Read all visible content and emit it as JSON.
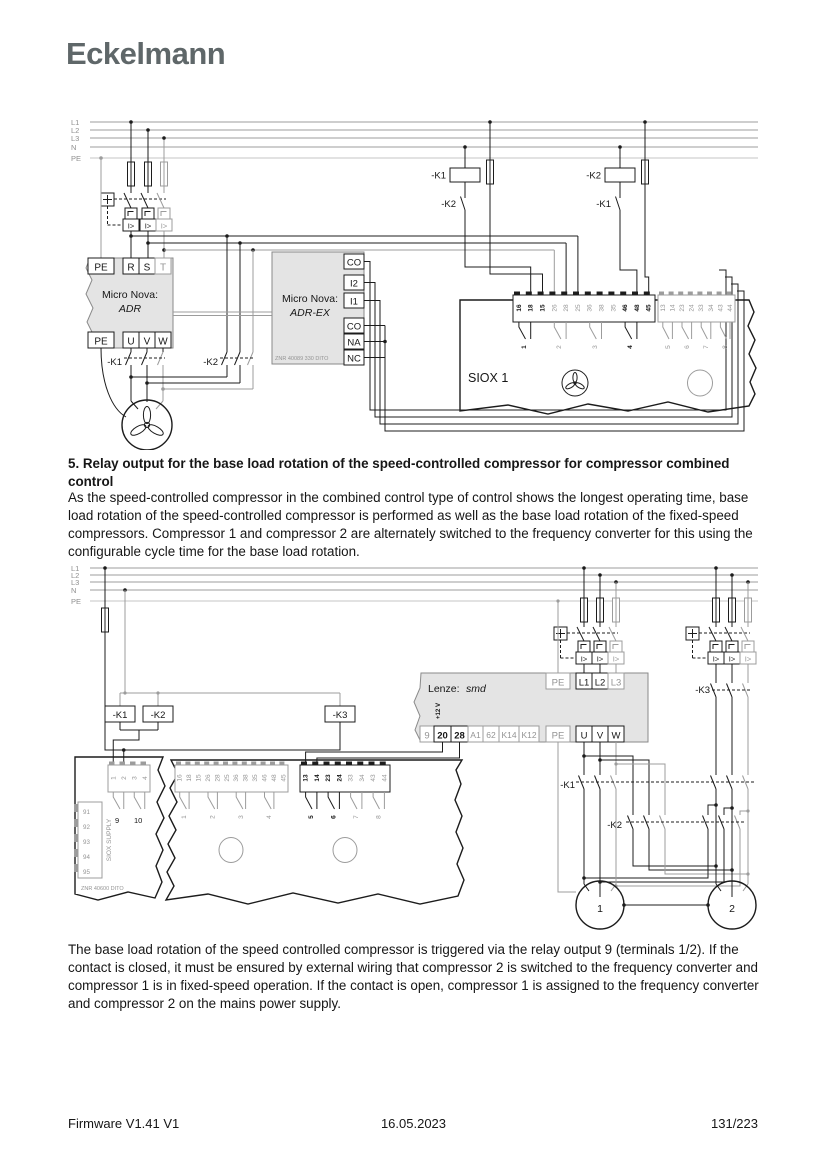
{
  "logo": "Eckelmann",
  "section": {
    "heading": "5. Relay output for the base load rotation of the speed-controlled compressor for compressor combined control",
    "para1": "As the speed-controlled compressor in the combined control type of control shows the longest operating time, base load rotation of the speed-controlled compressor is performed as well as the base load rotation of the fixed-speed compressors. Compressor 1 and compressor 2 are alternately switched to the frequency converter for this using the configurable cycle time for the base load rotation.",
    "para2": "The base load rotation of the speed controlled compressor is triggered via the relay output 9 (terminals 1/2). If the contact is closed, it must be ensured by external wiring that compressor 2 is switched to the frequency converter and compressor 1 is in fixed-speed operation. If the contact is open, compressor 1 is assigned to the frequency converter and compressor 2 on the mains power supply.",
    "overload_symbol": "I>"
  },
  "footer": {
    "left": "Firmware V1.41 V1",
    "center": "16.05.2023",
    "right": "131/223"
  },
  "colors": {
    "logo": "#5f6769",
    "line": "#1c1c1c",
    "gray_line": "#9c9c9c",
    "box_fill": "#e4e4e4"
  },
  "d1": {
    "rails": [
      "L1",
      "L2",
      "L3",
      "N",
      "PE"
    ],
    "adr_title": "Micro Nova:",
    "adr_model": "ADR",
    "adr_top": [
      "PE",
      "R",
      "S",
      "T"
    ],
    "adr_bottom": [
      "PE",
      "U",
      "V",
      "W"
    ],
    "k1": "-K1",
    "k2": "-K2",
    "adrex_title": "Micro Nova:",
    "adrex_model": "ADR-EX",
    "adrex_part": "ZNR 40089 330 DITO",
    "adrex_terms": [
      "CO",
      "I2",
      "I1",
      "CO",
      "NA",
      "NC"
    ],
    "coil1": "-K1",
    "coil1_aux": "-K2",
    "coil2": "-K2",
    "coil2_aux": "-K1",
    "siox_label": "SIOX 1",
    "strip1": [
      "16",
      "18",
      "15",
      "26",
      "28",
      "25",
      "36",
      "38",
      "35",
      "46",
      "48",
      "45"
    ],
    "relays1": [
      "1",
      "2",
      "3",
      "4"
    ],
    "strip2": [
      "13",
      "14",
      "23",
      "24",
      "33",
      "34",
      "43",
      "44"
    ],
    "relays2": [
      "5",
      "6",
      "7",
      "8"
    ]
  },
  "d2": {
    "rails": [
      "L1",
      "L2",
      "L3",
      "N",
      "PE"
    ],
    "k1": "-K1",
    "k2": "-K2",
    "k3": "-K3",
    "k1_row": "-K1",
    "k2_row": "-K2",
    "k3_row": "-K3",
    "lenze_brand": "Lenze:",
    "lenze_model": "smd",
    "v12": "+12 V",
    "lenze_top": [
      "PE",
      "L1",
      "L2",
      "L3"
    ],
    "lenze_bottom": [
      "9",
      "20",
      "28",
      "A1",
      "62",
      "K14",
      "K12",
      "PE",
      "U",
      "V",
      "W"
    ],
    "m1_strip": [
      "1",
      "2",
      "3",
      "4"
    ],
    "m1_relays": [
      "9",
      "10"
    ],
    "m1_side": [
      "91",
      "92",
      "93",
      "94",
      "95"
    ],
    "m1_supply": "SIOX SUPPLY",
    "m1_part": "ZNR 40600 DITO",
    "strip1": [
      "16",
      "18",
      "15",
      "26",
      "28",
      "25",
      "36",
      "38",
      "35",
      "46",
      "48",
      "45"
    ],
    "relays1": [
      "1",
      "2",
      "3",
      "4"
    ],
    "strip2": [
      "13",
      "14",
      "23",
      "24",
      "33",
      "34",
      "43",
      "44"
    ],
    "relays2": [
      "5",
      "6",
      "7",
      "8"
    ],
    "motor1": "1",
    "motor2": "2"
  }
}
